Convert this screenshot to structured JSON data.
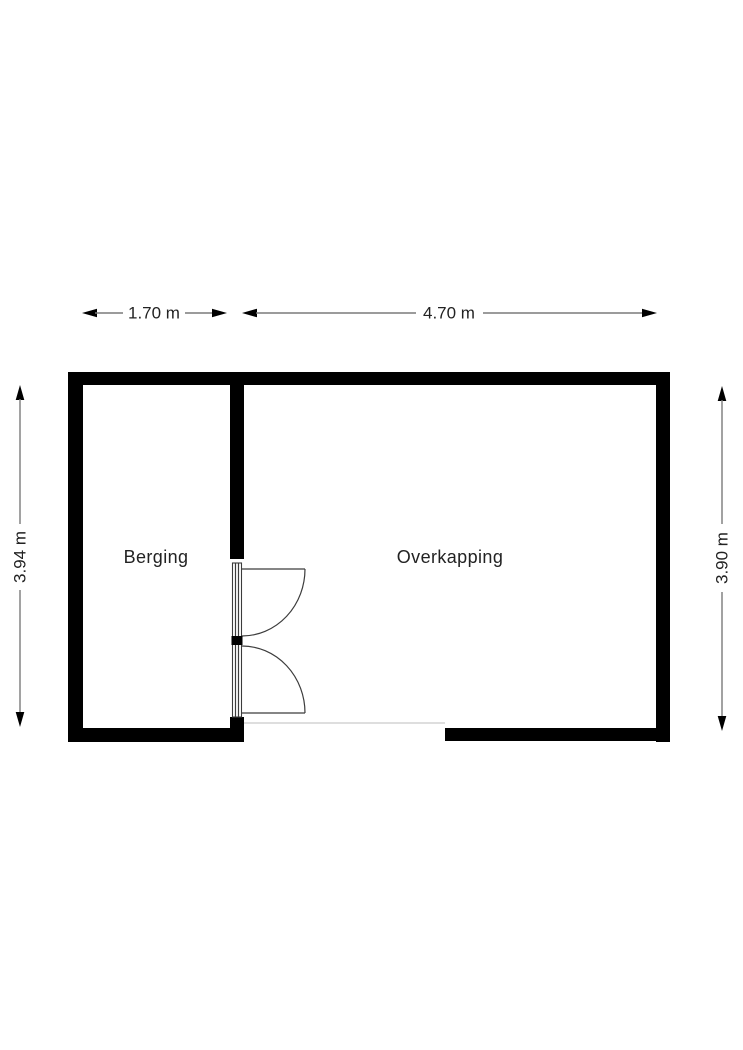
{
  "floorplan": {
    "rooms": [
      {
        "id": "berging",
        "label": "Berging"
      },
      {
        "id": "overkapping",
        "label": "Overkapping"
      }
    ],
    "dimensions": {
      "top_berging": "1.70 m",
      "top_overkapping": "4.70 m",
      "left": "3.94 m",
      "right": "3.90 m"
    },
    "colors": {
      "background": "#ffffff",
      "wall": "#000000",
      "dimension_line": "#7a7a7a",
      "arrowhead": "#000000",
      "text": "#222222",
      "door_line": "#3c3c3c",
      "open_edge_line": "#dedede"
    }
  }
}
